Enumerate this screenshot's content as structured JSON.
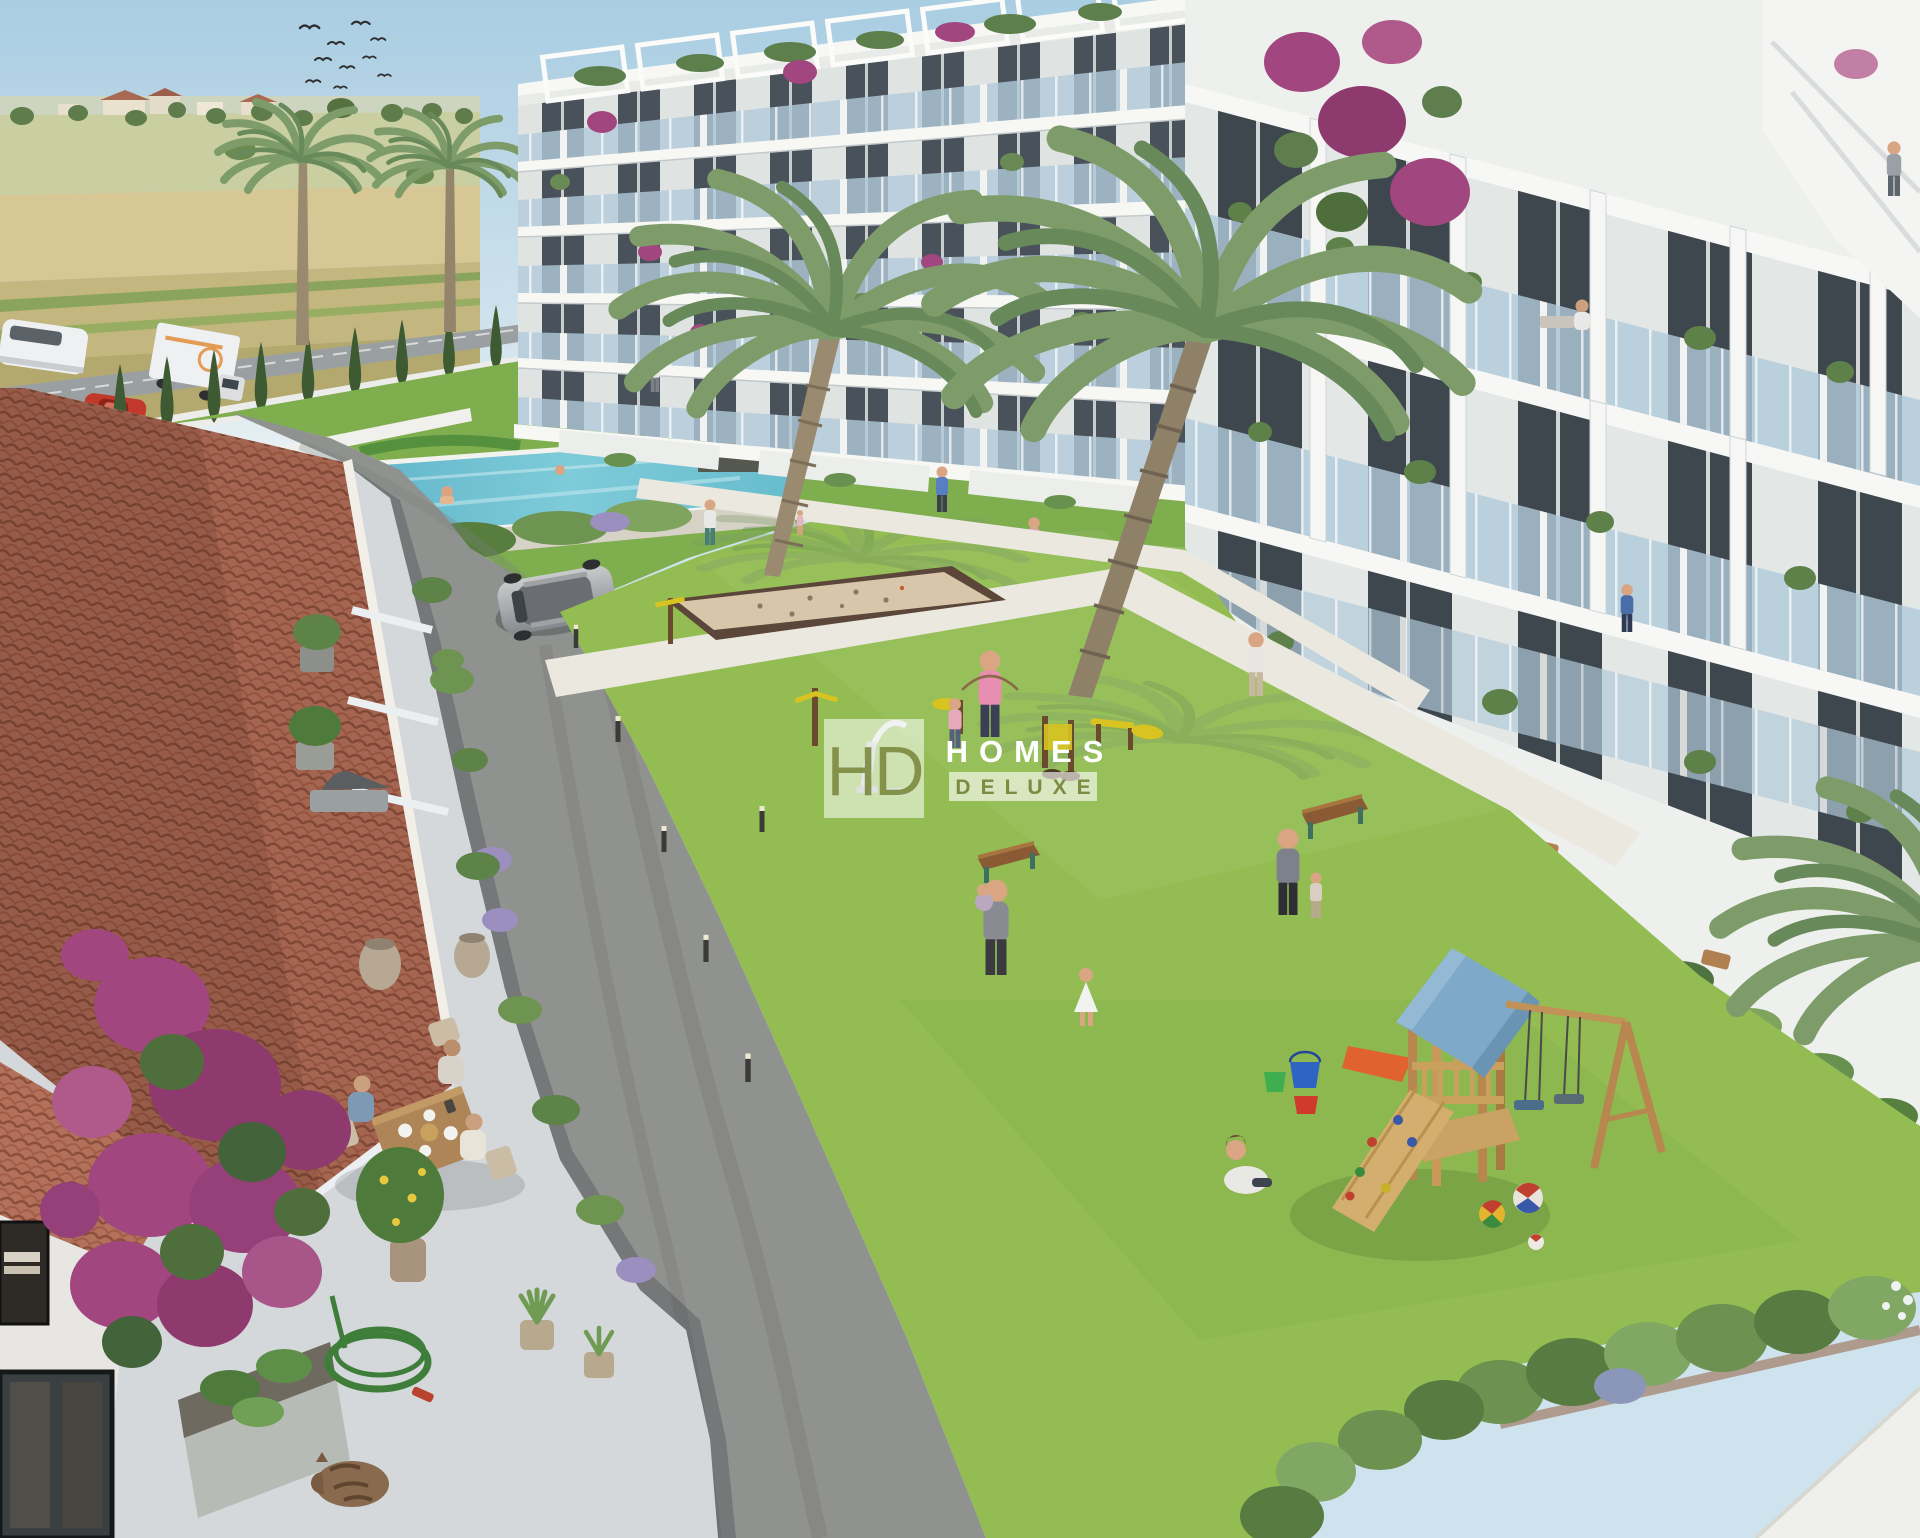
{
  "scene": {
    "kind": "aerial architectural render",
    "subject": "new-build residential complex with communal garden, pool, outdoor gym and playground"
  },
  "watermark": {
    "monogram": "HD",
    "title": "HOMES",
    "subtitle": "DELUXE",
    "accent_green": "#7d8b41",
    "text_white": "#ffffff",
    "box_fill": "rgba(255,255,255,0.55)",
    "sub_box_fill": "rgba(255,255,255,0.62)"
  },
  "palette": {
    "sky_top": "#a9cde2",
    "sky_horizon": "#e9f1f4",
    "field_wheat": "#d2c492",
    "field_green": "#9db26b",
    "lawn": "#93bd52",
    "garden_lawn": "#7fae4f",
    "hedge_dark": "#4a6b3a",
    "cypress": "#3e5a33",
    "pool_water": "#66bccd",
    "asphalt": "#909290",
    "path_light": "#eae8df",
    "building_white": "#f1f2f0",
    "balcony_glass": "#b2cbdb",
    "window_dark": "#49525a",
    "roof_terracotta": "#b3705a",
    "roof_joint": "#8a4e3b",
    "bougainvillea": "#a1467f",
    "palm_frond": "#7d9c6a",
    "play_wood": "#c9a05e",
    "play_roof_blue": "#7fa9c9",
    "slide_orange": "#e0622e",
    "sand_court": "#d9c5aa"
  }
}
